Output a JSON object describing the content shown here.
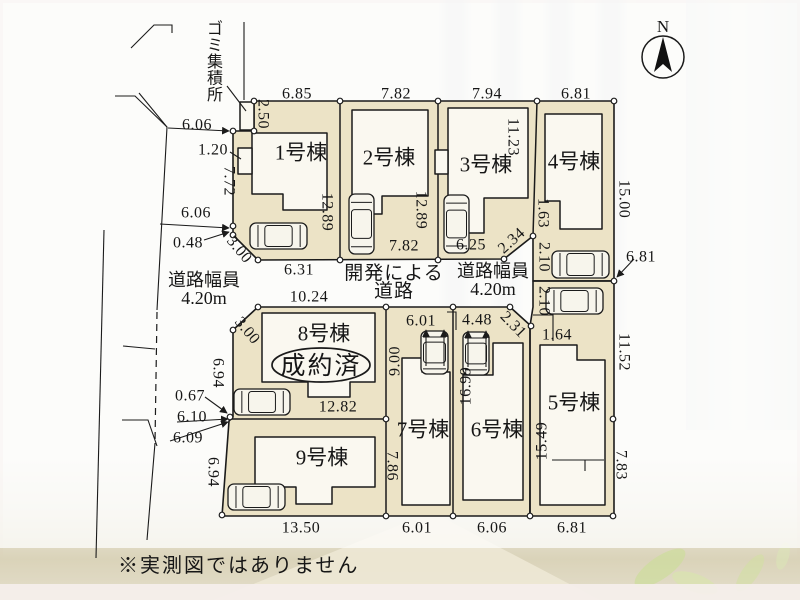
{
  "compass": {
    "label": "N"
  },
  "disclaimer": "※実測図ではありません",
  "garbage": {
    "label": "ゴミ集積所"
  },
  "sold_badge": "成約済",
  "center_road": [
    "開発による",
    "道路"
  ],
  "road_width_left": [
    "道路幅員",
    "4.20m"
  ],
  "road_width_right": [
    "道路幅員",
    "4.20m"
  ],
  "colors": {
    "lot_fill": "#ece3c6",
    "building_fill": "#faf8f0",
    "line": "#1b1b1b",
    "wall": "#dad3b9",
    "leaf": "#cddc9e"
  },
  "lots": [
    {
      "name": "1号棟",
      "x": 301,
      "y": 152
    },
    {
      "name": "2号棟",
      "x": 389,
      "y": 157
    },
    {
      "name": "3号棟",
      "x": 486,
      "y": 164
    },
    {
      "name": "4号棟",
      "x": 574,
      "y": 161
    },
    {
      "name": "5号棟",
      "x": 574,
      "y": 402
    },
    {
      "name": "6号棟",
      "x": 497,
      "y": 429
    },
    {
      "name": "7号棟",
      "x": 423,
      "y": 429
    },
    {
      "name": "8号棟",
      "x": 324,
      "y": 333
    },
    {
      "name": "9号棟",
      "x": 322,
      "y": 457
    }
  ],
  "dimensions": [
    {
      "v": "6.85",
      "x": 297,
      "y": 93,
      "r": 0
    },
    {
      "v": "7.82",
      "x": 396,
      "y": 93,
      "r": 0
    },
    {
      "v": "7.94",
      "x": 487,
      "y": 93,
      "r": 0
    },
    {
      "v": "6.81",
      "x": 576,
      "y": 93,
      "r": 0
    },
    {
      "v": "2.50",
      "x": 264,
      "y": 114,
      "r": 90
    },
    {
      "v": "6.06",
      "x": 197,
      "y": 124,
      "r": 0
    },
    {
      "v": "1.20",
      "x": 213,
      "y": 149,
      "r": 0
    },
    {
      "v": "7.72",
      "x": 230,
      "y": 181,
      "r": 90
    },
    {
      "v": "6.06",
      "x": 196,
      "y": 212,
      "r": 0
    },
    {
      "v": "0.48",
      "x": 188,
      "y": 242,
      "r": 0
    },
    {
      "v": "3.00",
      "x": 240,
      "y": 249,
      "r": 50
    },
    {
      "v": "12.89",
      "x": 328,
      "y": 212,
      "r": 90
    },
    {
      "v": "12.89",
      "x": 422,
      "y": 210,
      "r": 90
    },
    {
      "v": "11.23",
      "x": 514,
      "y": 137,
      "r": 90
    },
    {
      "v": "15.00",
      "x": 625,
      "y": 199,
      "r": 90
    },
    {
      "v": "7.82",
      "x": 404,
      "y": 245,
      "r": 0
    },
    {
      "v": "6.25",
      "x": 471,
      "y": 244,
      "r": 0
    },
    {
      "v": "2.34",
      "x": 511,
      "y": 240,
      "r": -42
    },
    {
      "v": "1.63",
      "x": 544,
      "y": 213,
      "r": 90
    },
    {
      "v": "2.10",
      "x": 545,
      "y": 257,
      "r": 90
    },
    {
      "v": "2.10",
      "x": 545,
      "y": 301,
      "r": 90
    },
    {
      "v": "6.81",
      "x": 641,
      "y": 256,
      "r": 0
    },
    {
      "v": "1.64",
      "x": 557,
      "y": 334,
      "r": 0
    },
    {
      "v": "2.31",
      "x": 514,
      "y": 324,
      "r": 46
    },
    {
      "v": "4.48",
      "x": 477,
      "y": 319,
      "r": 0
    },
    {
      "v": "6.01",
      "x": 421,
      "y": 320,
      "r": 0
    },
    {
      "v": "6.31",
      "x": 299,
      "y": 269,
      "r": 0
    },
    {
      "v": "10.24",
      "x": 309,
      "y": 296,
      "r": 0
    },
    {
      "v": "3.00",
      "x": 248,
      "y": 330,
      "r": 50
    },
    {
      "v": "6.94",
      "x": 219,
      "y": 373,
      "r": 90
    },
    {
      "v": "9.00",
      "x": 394,
      "y": 361,
      "r": -90
    },
    {
      "v": "16.99",
      "x": 465,
      "y": 386,
      "r": -90
    },
    {
      "v": "0.67",
      "x": 190,
      "y": 395,
      "r": 0
    },
    {
      "v": "6.10",
      "x": 192,
      "y": 416,
      "r": 0
    },
    {
      "v": "6.09",
      "x": 188,
      "y": 437,
      "r": 0
    },
    {
      "v": "12.82",
      "x": 338,
      "y": 406,
      "r": 0
    },
    {
      "v": "6.94",
      "x": 214,
      "y": 472,
      "r": 90
    },
    {
      "v": "7.86",
      "x": 393,
      "y": 466,
      "r": 90
    },
    {
      "v": "15.49",
      "x": 541,
      "y": 441,
      "r": -90
    },
    {
      "v": "11.52",
      "x": 625,
      "y": 352,
      "r": 90
    },
    {
      "v": "7.83",
      "x": 622,
      "y": 465,
      "r": 90
    },
    {
      "v": "13.50",
      "x": 301,
      "y": 527,
      "r": 0
    },
    {
      "v": "6.01",
      "x": 417,
      "y": 527,
      "r": 0
    },
    {
      "v": "6.06",
      "x": 492,
      "y": 527,
      "r": 0
    },
    {
      "v": "6.81",
      "x": 572,
      "y": 527,
      "r": 0
    }
  ],
  "markers": [
    [
      254,
      101
    ],
    [
      340,
      101
    ],
    [
      438,
      101
    ],
    [
      537,
      101
    ],
    [
      614,
      101
    ],
    [
      254,
      131
    ],
    [
      233,
      131
    ],
    [
      233,
      226
    ],
    [
      233,
      235
    ],
    [
      258,
      260
    ],
    [
      340,
      260
    ],
    [
      438,
      260
    ],
    [
      504,
      259
    ],
    [
      533,
      236
    ],
    [
      614,
      281
    ],
    [
      258,
      307
    ],
    [
      386,
      307
    ],
    [
      453,
      307
    ],
    [
      510,
      307
    ],
    [
      531,
      326
    ],
    [
      233,
      330
    ],
    [
      230,
      417
    ],
    [
      386,
      419
    ],
    [
      613,
      419
    ],
    [
      222,
      515
    ],
    [
      386,
      516
    ],
    [
      453,
      516
    ],
    [
      530,
      516
    ],
    [
      613,
      516
    ]
  ],
  "cars": [
    {
      "x": 250,
      "y": 223,
      "w": 57,
      "h": 26,
      "o": "h"
    },
    {
      "x": 349,
      "y": 194,
      "w": 25,
      "h": 60,
      "o": "v"
    },
    {
      "x": 444,
      "y": 195,
      "w": 25,
      "h": 58,
      "o": "v"
    },
    {
      "x": 552,
      "y": 251,
      "w": 57,
      "h": 27,
      "o": "h"
    },
    {
      "x": 546,
      "y": 288,
      "w": 57,
      "h": 26,
      "o": "h"
    },
    {
      "x": 421,
      "y": 331,
      "w": 27,
      "h": 43,
      "o": "v"
    },
    {
      "x": 463,
      "y": 332,
      "w": 26,
      "h": 43,
      "o": "v"
    },
    {
      "x": 234,
      "y": 389,
      "w": 56,
      "h": 26,
      "o": "h"
    },
    {
      "x": 228,
      "y": 484,
      "w": 57,
      "h": 26,
      "o": "h"
    }
  ],
  "car_arrows": [
    [
      426,
      366,
      426,
      330
    ],
    [
      444,
      366,
      444,
      330
    ],
    [
      468,
      367,
      468,
      331
    ],
    [
      486,
      367,
      486,
      331
    ]
  ]
}
